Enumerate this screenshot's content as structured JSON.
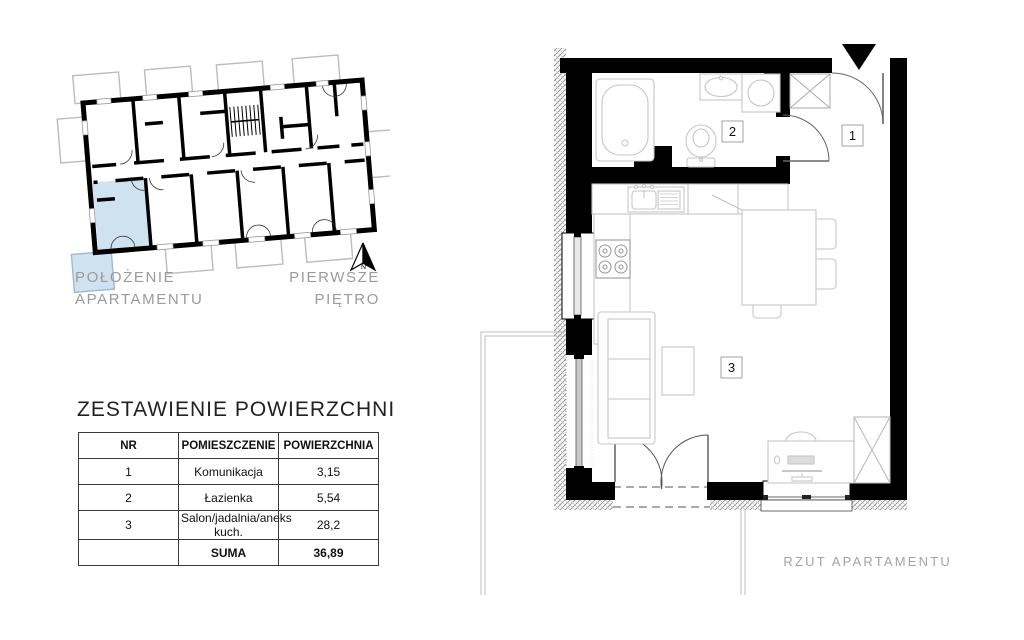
{
  "overview": {
    "caption_line1": "POŁOŻENIE",
    "caption_line2": "APARTAMENTU",
    "floor_line1": "PIERWSZE",
    "floor_line2": "PIĘTRO",
    "north_letter": "N"
  },
  "area_table": {
    "title": "ZESTAWIENIE POWIERZCHNI",
    "columns": [
      "NR",
      "POMIESZCZENIE",
      "POWIERZCHNIA"
    ],
    "rows": [
      {
        "nr": "1",
        "name": "Komunikacja",
        "area": "3,15"
      },
      {
        "nr": "2",
        "name": "Łazienka",
        "area": "5,54"
      },
      {
        "nr": "3",
        "name": "Salon/jadalnia/aneks kuch.",
        "area": "28,2"
      }
    ],
    "total_label": "SUMA",
    "total_value": "36,89"
  },
  "floor_plan": {
    "caption": "RZUT APARTAMENTU",
    "room_labels": [
      {
        "nr": "1"
      },
      {
        "nr": "2"
      },
      {
        "nr": "3"
      }
    ]
  },
  "colors": {
    "wall": "#000000",
    "apartment_highlight": "#cfe2f0",
    "highlight_border": "#9db8cf",
    "furniture_outline": "#c6c6c6",
    "caption_gray": "#9b9b9b"
  }
}
